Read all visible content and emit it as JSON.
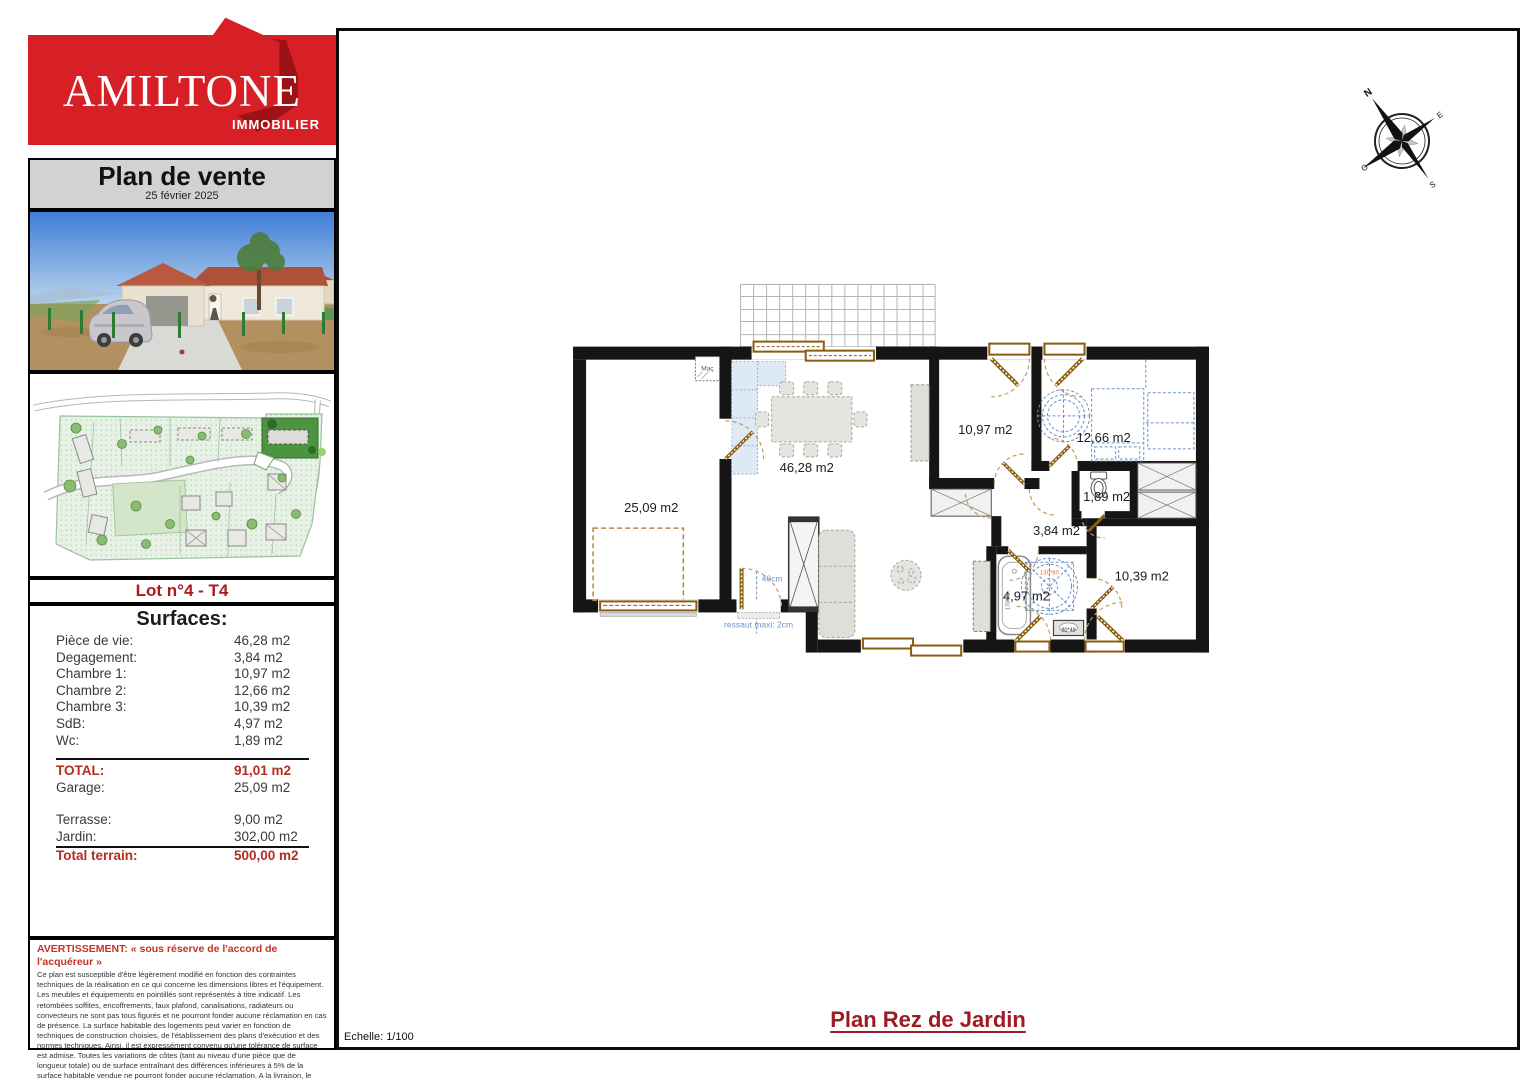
{
  "logo": {
    "brand": "AMILTONE",
    "tagline": "IMMOBILIER"
  },
  "header": {
    "title": "Plan de vente",
    "date": "25 février 2025"
  },
  "lot_title": "Lot n°4 - T4",
  "surfaces": {
    "title": "Surfaces:",
    "rows": [
      {
        "label": "Pièce de vie:",
        "value": "46,28 m2"
      },
      {
        "label": "Degagement:",
        "value": "3,84 m2"
      },
      {
        "label": "Chambre 1:",
        "value": "10,97 m2"
      },
      {
        "label": "Chambre 2:",
        "value": "12,66 m2"
      },
      {
        "label": "Chambre 3:",
        "value": "10,39 m2"
      },
      {
        "label": "SdB:",
        "value": "4,97 m2"
      },
      {
        "label": "Wc:",
        "value": "1,89 m2"
      }
    ],
    "total": {
      "label": "TOTAL:",
      "value": "91,01 m2"
    },
    "garage": {
      "label": "Garage:",
      "value": "25,09 m2"
    },
    "terrasse": {
      "label": "Terrasse:",
      "value": "9,00 m2"
    },
    "jardin": {
      "label": "Jardin:",
      "value": "302,00 m2"
    },
    "total_terrain": {
      "label": "Total terrain:",
      "value": "500,00 m2"
    }
  },
  "warning": {
    "title": "AVERTISSEMENT: « sous réserve de l'accord de l'acquéreur »",
    "body1": "Ce plan est susceptible d'être légèrement modifié en fonction des contraintes techniques de la réalisation en ce qui concerne les dimensions libres et l'équipement.",
    "body2": "Les meubles et équipements en pointillés sont représentés à titre indicatif. Les retombées soffites, encoffrements, faux plafond, canalisations, radiateurs ou convecteurs ne sont pas tous figurés et ne pourront fonder aucune réclamation en cas de présence. La surface habitable des logements peut varier en fonction de techniques de construction choisies, de l'établissement des plans d'exécution et des normes techniques. Ainsi, il est expressément convenu qu'une tolérance de surface est admise. Toutes les variations de côtes (tant au niveau d'une pièce que de longueur totale) ou de surface entraînant des différences inférieures à 5% de la surface habitable vendue ne pourront fonder aucune réclamation. A la livraison, le terrain pourra présenter des différences de niveau dues à la topographie naturelle du lieu, au calage des voiries, et aux contraintes techniques liées à la construction."
  },
  "plan": {
    "rooms": {
      "garage": "25,09 m2",
      "piece_de_vie": "46,28 m2",
      "chambre1": "10,97 m2",
      "chambre2": "12,66 m2",
      "wc": "1,89 m2",
      "degagement": "3,84 m2",
      "chambre3": "10,39 m2",
      "sdb": "4,97 m2"
    },
    "annotations": {
      "maconnerie": "Maç",
      "seuil": "40cm",
      "ressaut": "ressaut maxi: 2cm",
      "douche": "130*80",
      "lavabo": "80*48",
      "baignoire": "170*70"
    },
    "compass": {
      "n": "N",
      "e": "E",
      "s": "S",
      "o": "O"
    }
  },
  "footer": {
    "title": "Plan Rez de Jardin",
    "scale": "Echelle: 1/100"
  },
  "colors": {
    "brand_red": "#d71f26",
    "dark_red": "#9d1c23",
    "accent_red": "#b32c20",
    "wall": "#151515",
    "joinery_brown": "#8a5c10",
    "annotation_blue": "#6b93c9"
  }
}
